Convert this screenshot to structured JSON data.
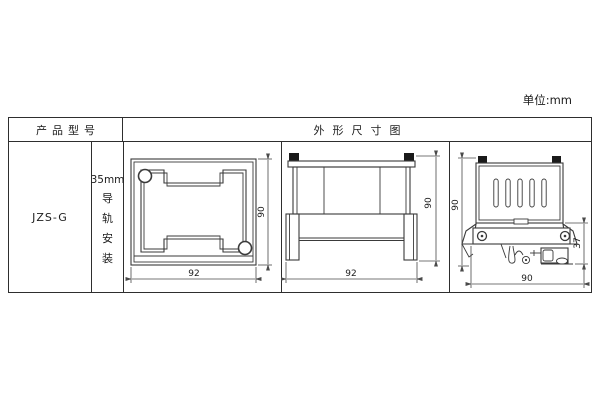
{
  "meta": {
    "unit_label": "单位:mm"
  },
  "table": {
    "headers": {
      "product_model": "产品型号",
      "outline_diagram": "外形尺寸图"
    },
    "row": {
      "model": "JZS-G",
      "mounting": {
        "size": "35mm",
        "chars": [
          "导",
          "轨",
          "安",
          "装"
        ]
      }
    }
  },
  "drawings": {
    "front_view": {
      "width": "92",
      "height": "90"
    },
    "side_view": {
      "width": "92",
      "height": "90"
    },
    "rail_view": {
      "height": "90",
      "clip_depth": "37",
      "width": "90"
    }
  },
  "colors": {
    "background": "#ffffff",
    "table_border": "#2e2e2e",
    "drawing_line": "#3a3a3a",
    "dimension_line": "#4a4a4a",
    "text": "#1c1c1c",
    "mount_tab_fill": "#1a1a1a"
  }
}
